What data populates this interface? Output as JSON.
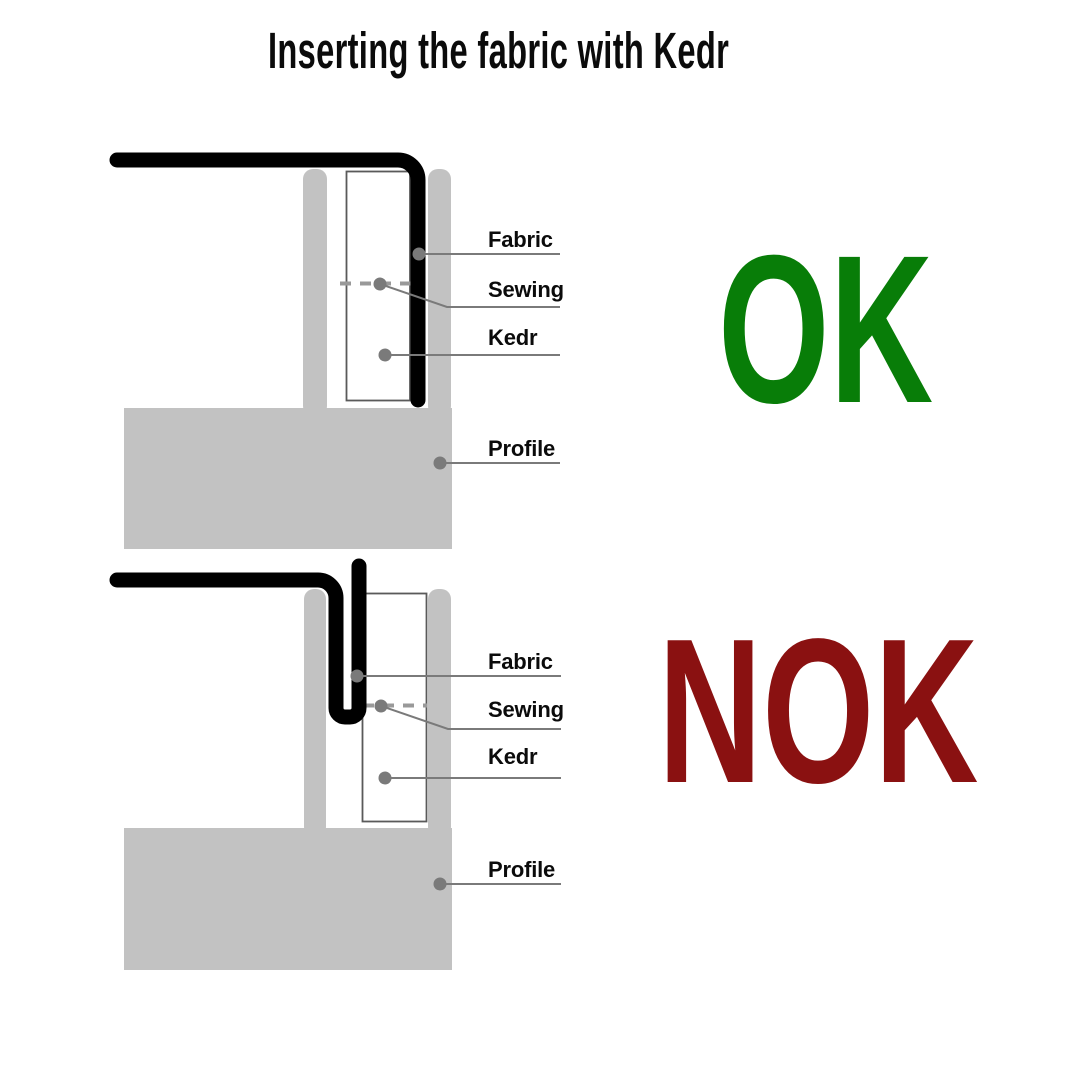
{
  "title": "Inserting the fabric with Kedr",
  "colors": {
    "ok_green": "#087d08",
    "nok_red": "#8a1111",
    "profile_gray": "#c2c2c2",
    "fabric_black": "#000000",
    "callout_gray": "#7a7a7a"
  },
  "diagrams": [
    {
      "verdict": "OK",
      "labels": {
        "fabric": "Fabric",
        "sewing": "Sewing",
        "kedr": "Kedr",
        "profile": "Profile"
      }
    },
    {
      "verdict": "NOK",
      "labels": {
        "fabric": "Fabric",
        "sewing": "Sewing",
        "kedr": "Kedr",
        "profile": "Profile"
      }
    }
  ]
}
